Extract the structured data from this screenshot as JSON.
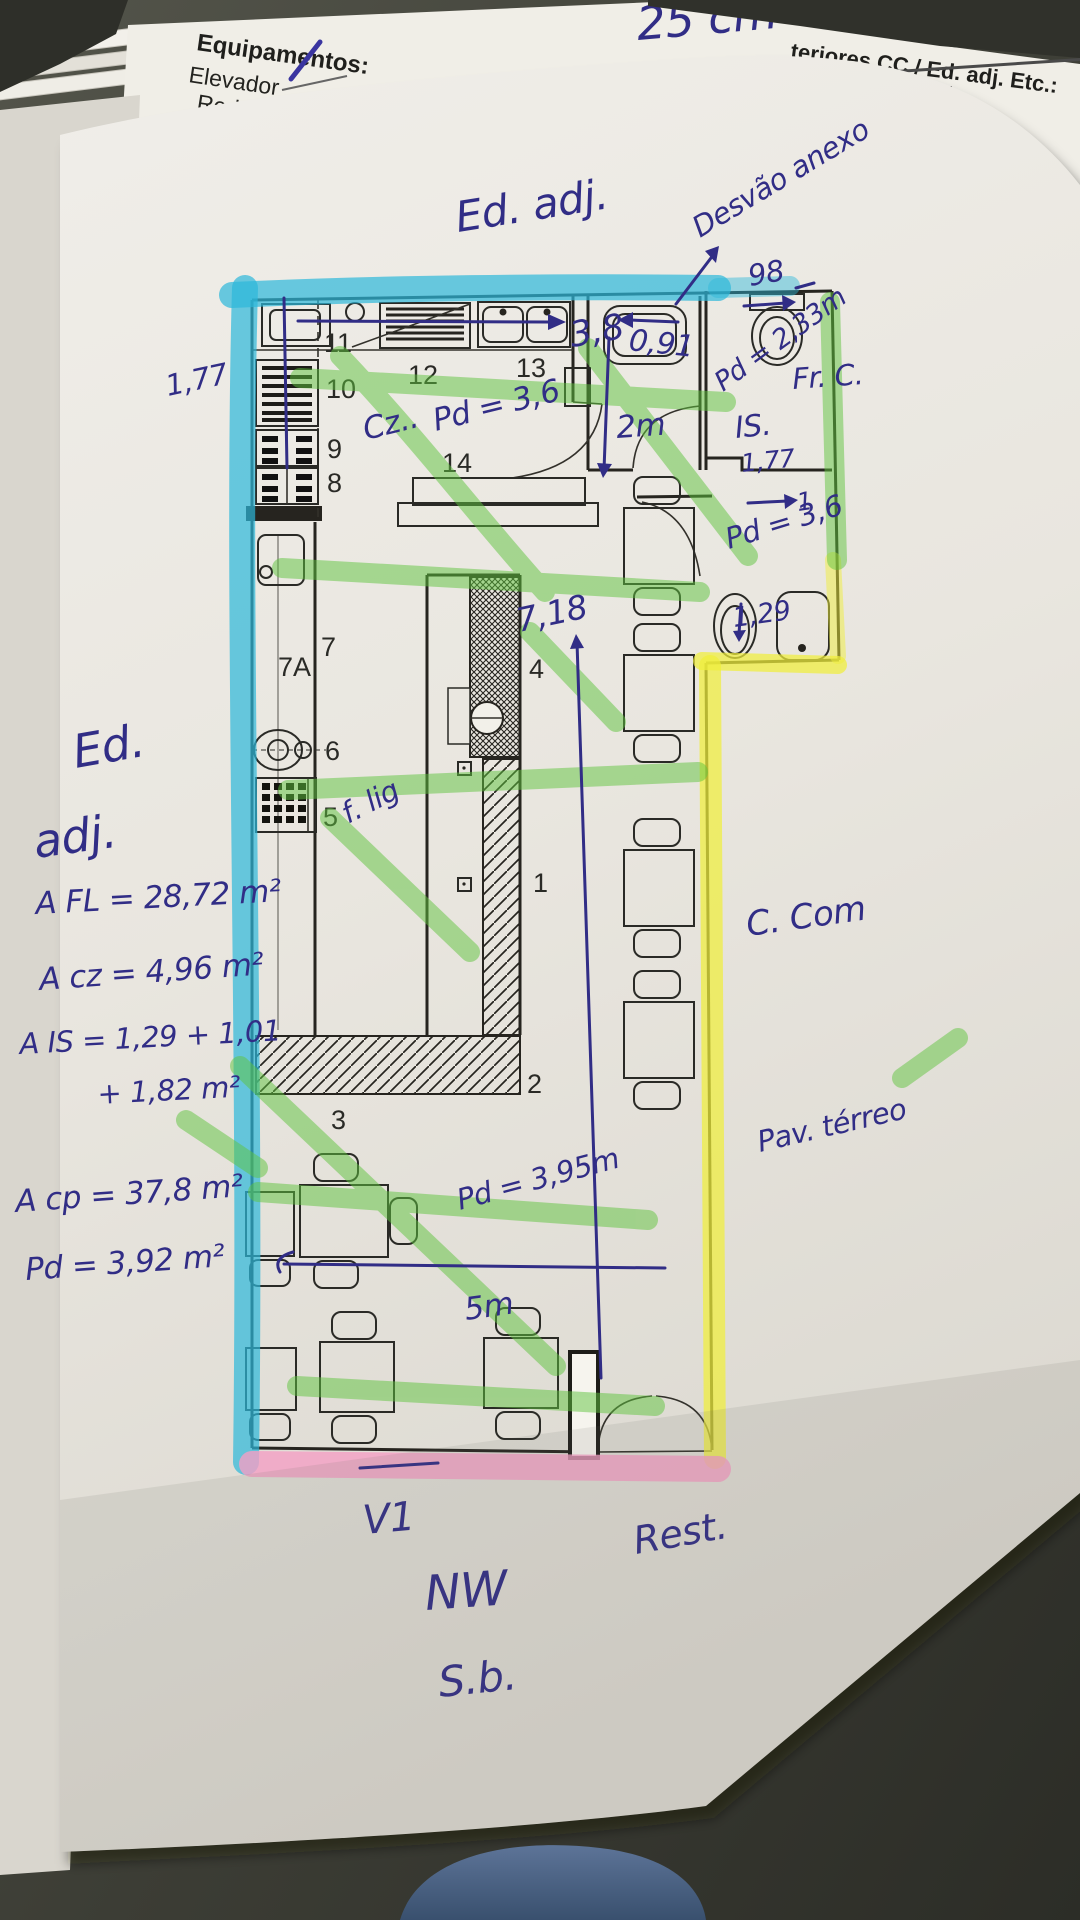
{
  "photo": {
    "colors": {
      "ink_blue": "#312d86",
      "highlighter_cyan": "#2cb8da",
      "highlighter_green": "#5fc43e",
      "highlighter_yellow": "#f0ee3c",
      "highlighter_pink": "#f49fc4",
      "desk": "#3c3d35",
      "paper": "#eae7e0"
    }
  },
  "top_sheet": {
    "dim_note": "25 cm",
    "equipment_header": "Equipamentos:",
    "equipment_item": "Elevador",
    "equipment_item_2": "Rede de G",
    "right_header": "teriores CC / Ed. adj. Etc.:",
    "field_label": "ra:",
    "field_value": "15cm"
  },
  "plan": {
    "rooms": [
      "11",
      "10",
      "9",
      "8",
      "12",
      "13",
      "14",
      "7",
      "7A",
      "6",
      "5",
      "4",
      "1",
      "2",
      "3"
    ]
  },
  "annotations": {
    "ed_adj_top": "Ed. adj.",
    "desvao_anexo": "Desvão anexo",
    "dim_98": "98",
    "dim_091": "0,91",
    "pd_233": "Pd = 2,33m",
    "is_label": "IS.",
    "dim_177_right": "1,77",
    "dim_1": "1",
    "pd_36_right": "Pd = 3,6",
    "dim_129": "1,29",
    "dim_2m": "2m",
    "dim_38": "3,8",
    "cz_label": "Cz..",
    "pd_36_kitchen": "Pd = 3,6",
    "dim_177_left": "1,77",
    "fr_c": "Fr. C.",
    "ed_left_line1": "Ed.",
    "ed_left_line2": "adj.",
    "f_lig": "f. lig",
    "dim_718": "7,18",
    "c_com": "C. Com",
    "pav_terreo": "Pav. térreo",
    "pd_395": "Pd = 3,95m",
    "dim_5m": "5m",
    "v1": "V1",
    "rest": "Rest.",
    "nw": "NW",
    "sb": "S.b."
  },
  "calculations": {
    "a_fl": "A FL = 28,72 m²",
    "a_cz": "A cz = 4,96 m²",
    "a_is_line1": "A IS = 1,29 + 1,01",
    "a_is_line2": "+ 1,82 m²",
    "a_cp": "A cp = 37,8 m²",
    "pd_total": "Pd = 3,92 m²"
  }
}
